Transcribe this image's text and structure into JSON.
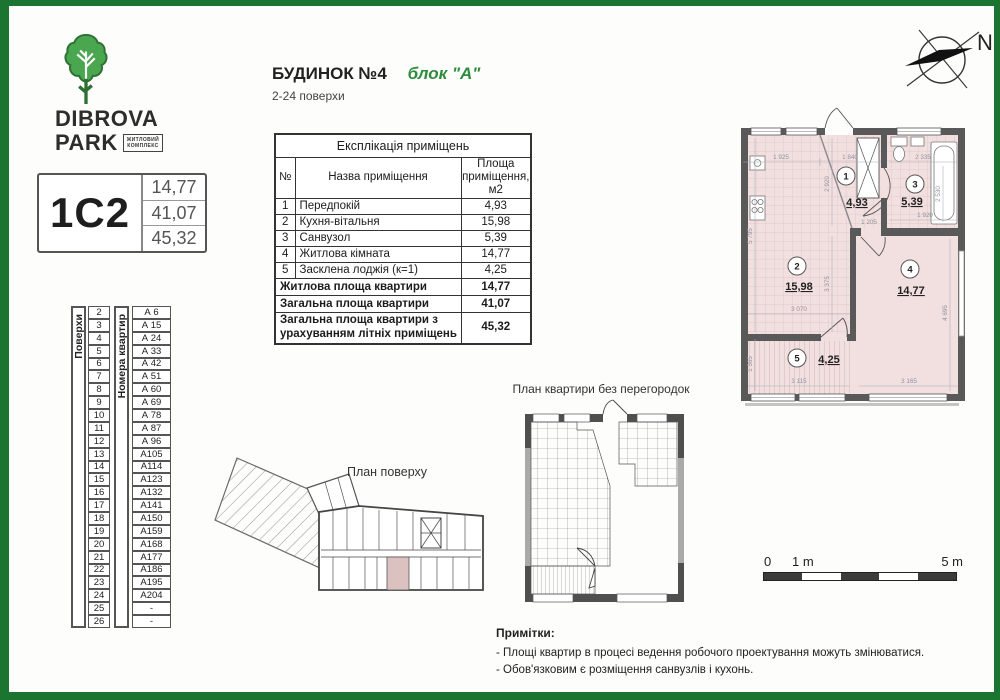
{
  "brand": {
    "name_line1": "DIBROVA",
    "name_line2": "PARK",
    "badge_line1": "ЖИТЛОВИЙ",
    "badge_line2": "КОМПЛЕКС"
  },
  "card": {
    "code": "1С2",
    "values": [
      "14,77",
      "41,07",
      "45,32"
    ]
  },
  "floors_table": {
    "label": "Поверхи",
    "rows": [
      "2",
      "3",
      "4",
      "5",
      "6",
      "7",
      "8",
      "9",
      "10",
      "11",
      "12",
      "13",
      "14",
      "15",
      "16",
      "17",
      "18",
      "19",
      "20",
      "21",
      "22",
      "23",
      "24",
      "25",
      "26"
    ]
  },
  "apartments_table": {
    "label": "Номера квартир",
    "rows": [
      "А 6",
      "А 15",
      "А 24",
      "А 33",
      "А 42",
      "А 51",
      "А 60",
      "А 69",
      "А 78",
      "А 87",
      "А 96",
      "А105",
      "А114",
      "А123",
      "А132",
      "А141",
      "А150",
      "А159",
      "А168",
      "А177",
      "А186",
      "А195",
      "А204",
      "-",
      "-"
    ]
  },
  "header": {
    "building": "БУДИНОК №4",
    "block": "блок \"А\"",
    "floors_range": "2-24 поверхи"
  },
  "explication": {
    "title": "Експлікація приміщень",
    "col_num": "№",
    "col_name": "Назва приміщення",
    "col_area": "Площа приміщення, м2",
    "rows": [
      {
        "n": "1",
        "name": "Передпокій",
        "area": "4,93"
      },
      {
        "n": "2",
        "name": "Кухня-вітальня",
        "area": "15,98"
      },
      {
        "n": "3",
        "name": "Санвузол",
        "area": "5,39"
      },
      {
        "n": "4",
        "name": "Житлова кімната",
        "area": "14,77"
      },
      {
        "n": "5",
        "name": "Засклена лоджія (к=1)",
        "area": "4,25"
      }
    ],
    "totals": [
      {
        "name": "Житлова площа квартири",
        "area": "14,77"
      },
      {
        "name": "Загальна площа квартири",
        "area": "41,07"
      },
      {
        "name": "Загальна площа квартири з урахуванням літніх приміщень",
        "area": "45,32"
      }
    ]
  },
  "plan": {
    "rooms": [
      {
        "num": "1",
        "area": "4,93"
      },
      {
        "num": "2",
        "area": "15,98"
      },
      {
        "num": "3",
        "area": "5,39"
      },
      {
        "num": "4",
        "area": "14,77"
      },
      {
        "num": "5",
        "area": "4,25"
      }
    ],
    "dims": {
      "w1": "1 925",
      "w2": "1 840",
      "w3": "2 335",
      "w4": "1 205",
      "w5": "1 920",
      "w6": "3 070",
      "w7": "3 165",
      "w8": "3 115",
      "h1": "2 920",
      "h2": "2 530",
      "h3": "5 795",
      "h4": "3 375",
      "h5": "4 695",
      "h6": "1 365"
    },
    "colors": {
      "room_fill": "#f2dfdf",
      "wall": "#595959",
      "highlight": "#dcc1c1",
      "accent_green": "#1c7431"
    }
  },
  "plans": {
    "no_partitions_title": "План квартири без перегородок",
    "floor_title": "План поверху"
  },
  "compass": {
    "north": "N"
  },
  "scale": {
    "zero": "0",
    "one": "1 m",
    "five": "5 m"
  },
  "notes": {
    "title": "Примітки:",
    "items": [
      "- Площі квартир в процесі ведення робочого проектування можуть змінюватися.",
      "- Обов'язковим є розміщення санвузлів і кухонь."
    ]
  }
}
